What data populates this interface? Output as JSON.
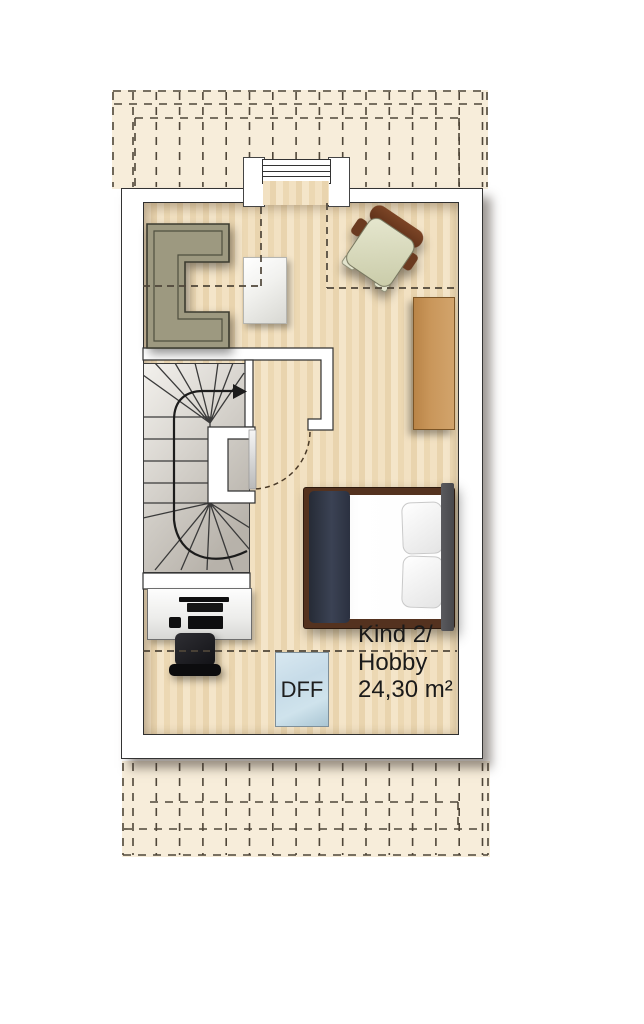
{
  "labels": {
    "room_line1": "Kind 2/",
    "room_line2": "Hobby",
    "room_area": "24,30 m²",
    "skylight": "DFF"
  },
  "colors": {
    "overhang": "#f7edda",
    "floor_light": "#f2e1c2",
    "floor_dark": "#e9d4ae",
    "dash": "#4f4639",
    "wall_outline": "#333333",
    "sofa": "#9d9980",
    "skylight_blue": "#c6dbe8",
    "bed_frame": "#54321f",
    "blanket": "#3b4254",
    "sideboard": "#c9965a",
    "stair_tread_line": "#3a3a3a"
  },
  "icons": {
    "stair_direction": "arrow-right"
  }
}
